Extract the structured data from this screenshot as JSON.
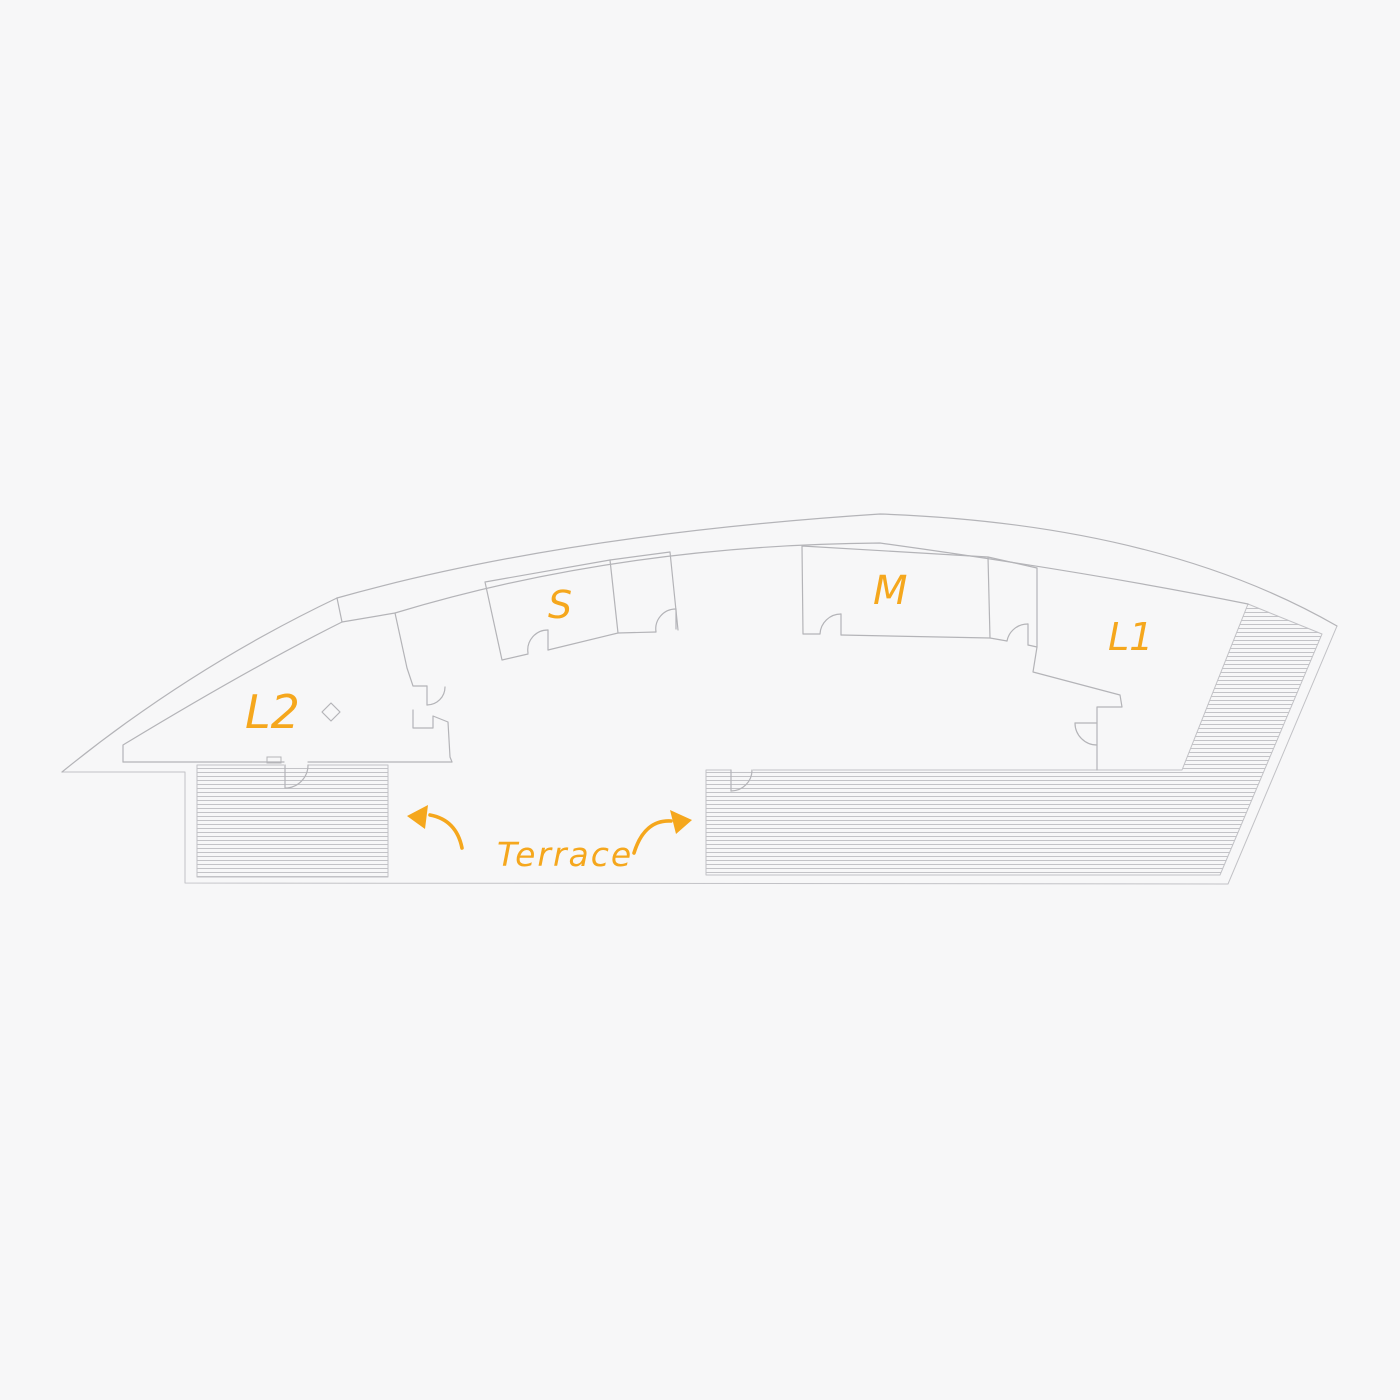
{
  "drawing": {
    "title": "Curved building floor plan sketch",
    "labels": {
      "room_l2": "L2",
      "room_s": "S",
      "room_m": "M",
      "room_l1": "L1",
      "terrace": "Terrace"
    },
    "colors": {
      "accent": "#F5A71D",
      "line": "#b4b4b8",
      "hatch": "#c3c3c7",
      "background": "#f7f7f8"
    }
  }
}
